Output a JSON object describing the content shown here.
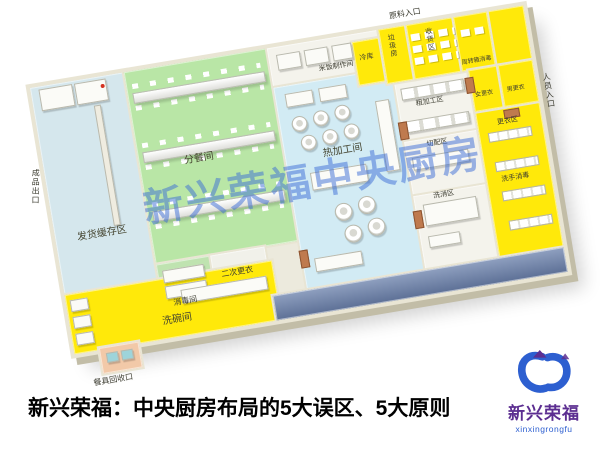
{
  "title": {
    "text": "新兴荣福：中央厨房布局的5大误区、5大原则"
  },
  "watermark": {
    "text": "新兴荣福中央厨房"
  },
  "logo": {
    "cn": "新兴荣福",
    "en": "xinxingrongfu"
  },
  "entrances": {
    "material": "原料入口",
    "staff": "人员入口",
    "product_exit": "成品出口",
    "tableware_return": "餐具回收口"
  },
  "rooms": {
    "shipping_buffer": "发货缓存区",
    "distribution": "分餐间",
    "disinfection": "消毒间",
    "second_changing": "二次更衣",
    "hot_processing": "热加工间",
    "rice": "米饭制作间",
    "rough_processing": "粗加工区",
    "cutting": "切配区",
    "wash_disinfect": "洗消区",
    "cold_storage": "冷库",
    "garbage": "垃圾房",
    "receiving": "收货区",
    "crate_wash": "周转箱消毒",
    "women_changing": "女更衣",
    "men_changing": "男更衣",
    "changing_area": "更衣区",
    "hand_wash": "洗手消毒",
    "dishwashing": "洗碗间"
  },
  "colors": {
    "floor-yellow": "#ffe90a",
    "floor-green": "#b9e6a6",
    "floor-blue": "#d2ebf4",
    "floor-lightblue": "#d5e7ed",
    "wall": "#e9e5d4",
    "dark-band": "#5d7096",
    "door": "#bf7a4e",
    "watermark-blue": "#3a6bd6",
    "logo-purple": "#5c2e91",
    "logo-blue": "#2d5fd0",
    "title-color": "#000000"
  }
}
